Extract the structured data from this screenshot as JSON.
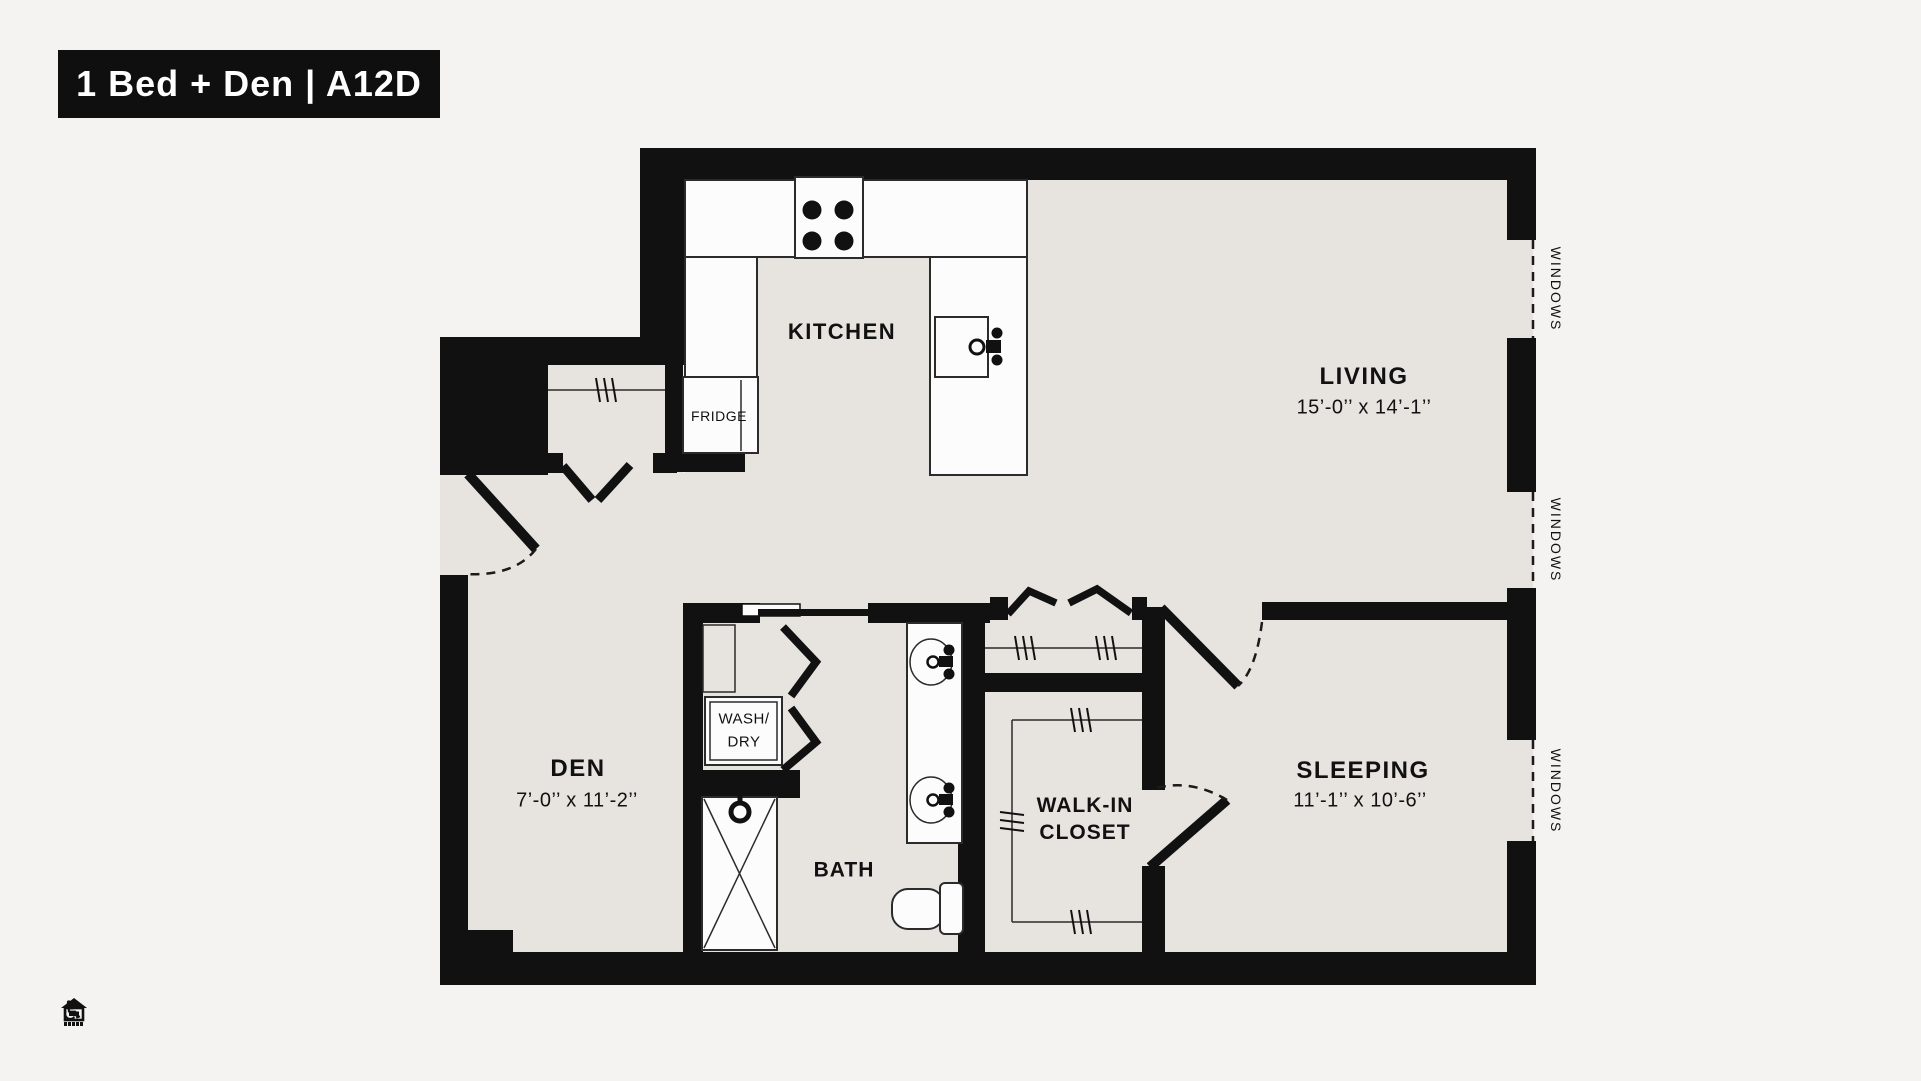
{
  "title": "1 Bed + Den | A12D",
  "colors": {
    "wall": "#111111",
    "floor": "#e7e4e0",
    "page": "#f4f3f1",
    "white": "#fcfcfc"
  },
  "rooms": {
    "kitchen": {
      "label": "KITCHEN"
    },
    "living": {
      "label": "LIVING",
      "dims": "15’-0’’ x 14’-1’’"
    },
    "den": {
      "label": "DEN",
      "dims": "7’-0’’ x 11’-2’’"
    },
    "sleeping": {
      "label": "SLEEPING",
      "dims": "11’-1’’ x 10’-6’’"
    },
    "bath": {
      "label": "BATH"
    },
    "walk_in_closet": {
      "line1": "WALK-IN",
      "line2": "CLOSET"
    }
  },
  "fixtures": {
    "fridge": "FRIDGE",
    "washer_dryer": {
      "line1": "WASH/",
      "line2": "DRY"
    }
  },
  "windows": {
    "label": "WINDOWS"
  },
  "footer": {
    "accessible_glyph": "♿"
  }
}
